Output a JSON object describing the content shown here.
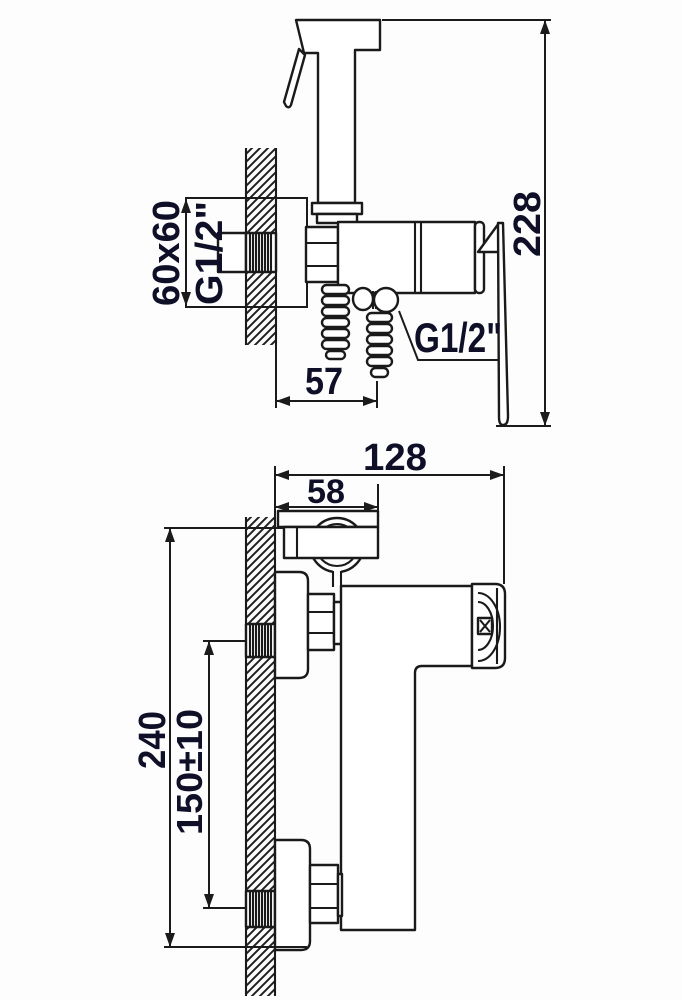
{
  "colors": {
    "background": "#fdfdfd",
    "line": "#1a1a1a",
    "text": "#0f0f28"
  },
  "side_view": {
    "plate_size_label": "60x60",
    "plate_thread_label": "G1/2\"",
    "hose_thread_label": "G1/2\"",
    "hose_offset_label": "57",
    "overall_height_label": "228"
  },
  "front_view": {
    "overall_depth_label": "128",
    "sprayer_depth_label": "58",
    "overall_height_label": "240",
    "connection_spacing_label": "150±10"
  }
}
